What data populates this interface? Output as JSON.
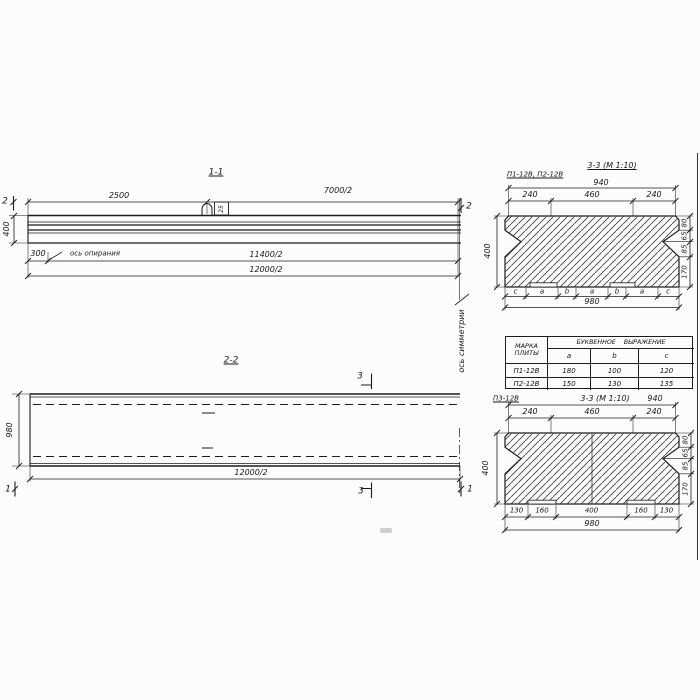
{
  "section_1_1": {
    "title": "1-1",
    "cut_label": "2",
    "dim_2500": "2500",
    "dim_7000_2": "7000/2",
    "dim_400": "400",
    "dim_300": "300",
    "dim_11400_2": "11400/2",
    "dim_12000_2": "12000/2",
    "bearing_axis": "ось опирания",
    "loop_tag": "25"
  },
  "section_2_2": {
    "title": "2-2",
    "cut_label_3": "3",
    "cut_label_1": "1",
    "dim_980": "980",
    "dim_12000_2": "12000/2",
    "symmetry_axis": "ось симметрии"
  },
  "section_3_3_upper": {
    "label": "П1-12В, П2-12В",
    "title": "3-3 (М 1:10)",
    "dim_940": "940",
    "dim_240_left": "240",
    "dim_460": "460",
    "dim_240_right": "240",
    "dim_400": "400",
    "right_dims": [
      "80",
      "65",
      "85",
      "170"
    ],
    "letters": [
      "c",
      "a",
      "b",
      "a",
      "b",
      "a",
      "c"
    ],
    "dim_980": "980"
  },
  "table": {
    "col1_line1": "МАРКА",
    "col1_line2": "ПЛИТЫ",
    "span_header": "БУКВЕННОЕ ВЫРАЖЕНИЕ",
    "sub_headers": [
      "a",
      "b",
      "c"
    ],
    "rows": [
      [
        "П1-12В",
        "180",
        "100",
        "120"
      ],
      [
        "П2-12В",
        "150",
        "130",
        "135"
      ]
    ]
  },
  "section_3_3_lower": {
    "label": "П3-12В",
    "title": "3-3 (М 1:10)",
    "dim_940": "940",
    "dim_240_left": "240",
    "dim_460": "460",
    "dim_240_right": "240",
    "dim_400": "400",
    "right_dims": [
      "80",
      "65",
      "85",
      "170"
    ],
    "bottom_dims": [
      "130",
      "160",
      "400",
      "160",
      "130"
    ],
    "dim_980": "980"
  }
}
